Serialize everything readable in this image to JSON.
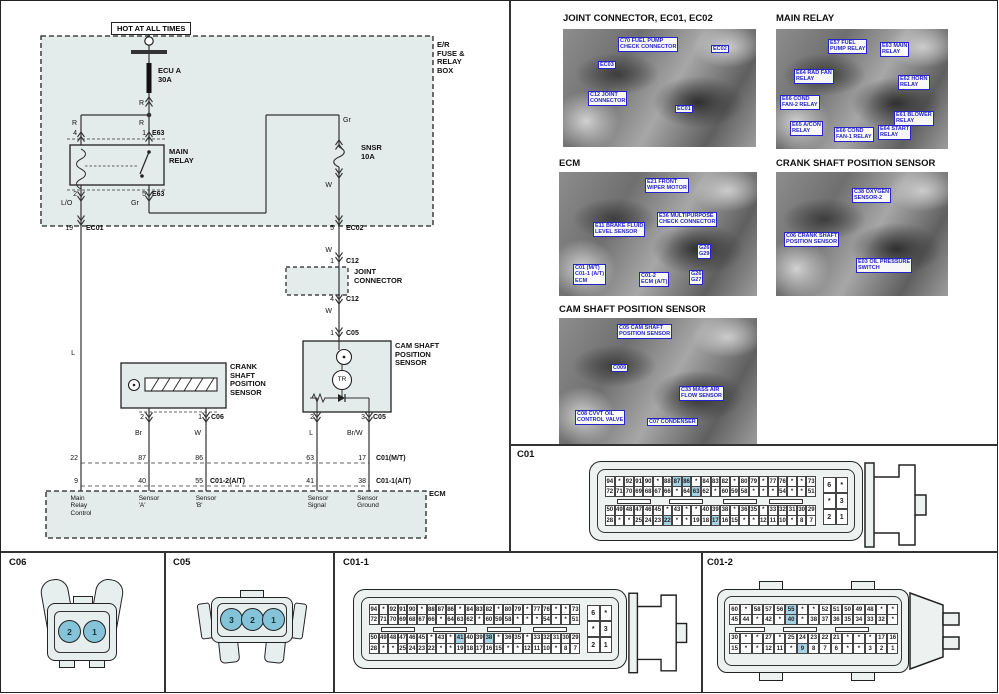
{
  "page": {
    "accent_blue": "#2424c8",
    "panel_fill": "#e3ecea",
    "highlight": "#a6d2e4"
  },
  "schematic": {
    "power_label": "HOT AT ALL TIMES",
    "annotations": [
      {
        "n": "er-fuse-relay-box",
        "t": "E/R\nFUSE &\nRELAY\nBOX",
        "x": 436,
        "y": 40,
        "b": 1,
        "fs": 7.5
      },
      {
        "n": "fuse-ecu-a",
        "t": "ECU A\n30A",
        "x": 157,
        "y": 66,
        "b": 1,
        "fs": 7.5
      },
      {
        "n": "wire-r-1",
        "t": "R",
        "x": 143,
        "y": 99,
        "al": "r"
      },
      {
        "n": "wire-r-2",
        "t": "R",
        "x": 76,
        "y": 119,
        "al": "r"
      },
      {
        "n": "wire-r-3",
        "t": "R",
        "x": 143,
        "y": 119,
        "al": "r"
      },
      {
        "n": "pin-4",
        "t": "4",
        "x": 76,
        "y": 129,
        "al": "r"
      },
      {
        "n": "pin-1",
        "t": "1",
        "x": 145,
        "y": 129,
        "al": "r"
      },
      {
        "n": "conn-e63-top",
        "t": "E63",
        "x": 151,
        "y": 129,
        "b": 1
      },
      {
        "n": "main-relay",
        "t": "MAIN\nRELAY",
        "x": 168,
        "y": 147,
        "b": 1,
        "fs": 7.5
      },
      {
        "n": "pin-2",
        "t": "2",
        "x": 76,
        "y": 190,
        "al": "r"
      },
      {
        "n": "pin-5",
        "t": "5",
        "x": 145,
        "y": 190,
        "al": "r"
      },
      {
        "n": "conn-e63-bottom",
        "t": "E63",
        "x": 151,
        "y": 190,
        "b": 1
      },
      {
        "n": "wire-lo",
        "t": "L/O",
        "x": 60,
        "y": 199
      },
      {
        "n": "wire-gr-1",
        "t": "Gr",
        "x": 130,
        "y": 199
      },
      {
        "n": "wire-gr-2",
        "t": "Gr",
        "x": 342,
        "y": 116
      },
      {
        "n": "fuse-snsr",
        "t": "SNSR\n10A",
        "x": 360,
        "y": 143,
        "b": 1,
        "fs": 7.5
      },
      {
        "n": "wire-w-1",
        "t": "W",
        "x": 331,
        "y": 181,
        "al": "r"
      },
      {
        "n": "pin-19",
        "t": "19",
        "x": 72,
        "y": 224,
        "al": "r"
      },
      {
        "n": "conn-ec01",
        "t": "EC01",
        "x": 85,
        "y": 224,
        "b": 1
      },
      {
        "n": "pin-5-ec02",
        "t": "5",
        "x": 333,
        "y": 224,
        "al": "r"
      },
      {
        "n": "conn-ec02",
        "t": "EC02",
        "x": 345,
        "y": 224,
        "b": 1
      },
      {
        "n": "wire-w-2",
        "t": "W",
        "x": 331,
        "y": 246,
        "al": "r"
      },
      {
        "n": "pin-1-c12",
        "t": "1",
        "x": 333,
        "y": 257,
        "al": "r"
      },
      {
        "n": "conn-c12-top",
        "t": "C12",
        "x": 345,
        "y": 257,
        "b": 1
      },
      {
        "n": "joint-connector",
        "t": "JOINT\nCONNECTOR",
        "x": 353,
        "y": 267,
        "b": 1,
        "fs": 7.5
      },
      {
        "n": "pin-4-c12",
        "t": "4",
        "x": 333,
        "y": 295,
        "al": "r"
      },
      {
        "n": "conn-c12-bottom",
        "t": "C12",
        "x": 345,
        "y": 295,
        "b": 1
      },
      {
        "n": "wire-w-3",
        "t": "W",
        "x": 331,
        "y": 307,
        "al": "r"
      },
      {
        "n": "pin-1-c05",
        "t": "1",
        "x": 333,
        "y": 329,
        "al": "r"
      },
      {
        "n": "conn-c05-top",
        "t": "C05",
        "x": 345,
        "y": 329,
        "b": 1
      },
      {
        "n": "cam-sensor",
        "t": "CAM SHAFT\nPOSITION\nSENSOR",
        "x": 394,
        "y": 341,
        "b": 1,
        "fs": 7.5
      },
      {
        "n": "tr",
        "t": "TR",
        "x": 341,
        "y": 375,
        "al": "c",
        "fs": 6.5
      },
      {
        "n": "wire-l-1",
        "t": "L",
        "x": 74,
        "y": 349,
        "al": "r"
      },
      {
        "n": "crank-sensor",
        "t": "CRANK\nSHAFT\nPOSITION\nSENSOR",
        "x": 229,
        "y": 362,
        "b": 1,
        "fs": 7.5
      },
      {
        "n": "pin-2-c06",
        "t": "2",
        "x": 143,
        "y": 413,
        "al": "r"
      },
      {
        "n": "pin-1-c06",
        "t": "1",
        "x": 201,
        "y": 413,
        "al": "r"
      },
      {
        "n": "conn-c06",
        "t": "C06",
        "x": 210,
        "y": 413,
        "b": 1
      },
      {
        "n": "pin-2-c05",
        "t": "2",
        "x": 313,
        "y": 413,
        "al": "r"
      },
      {
        "n": "pin-3-c05",
        "t": "3",
        "x": 364,
        "y": 413,
        "al": "r"
      },
      {
        "n": "conn-c05-bottom",
        "t": "C05",
        "x": 372,
        "y": 413,
        "b": 1
      },
      {
        "n": "wire-br",
        "t": "Br",
        "x": 141,
        "y": 429,
        "al": "r"
      },
      {
        "n": "wire-w-4",
        "t": "W",
        "x": 200,
        "y": 429,
        "al": "r"
      },
      {
        "n": "wire-l-2",
        "t": "L",
        "x": 312,
        "y": 429,
        "al": "r"
      },
      {
        "n": "wire-brw",
        "t": "Br/W",
        "x": 346,
        "y": 429
      },
      {
        "n": "ecm-pin-22",
        "t": "22",
        "x": 77,
        "y": 454,
        "al": "r"
      },
      {
        "n": "ecm-pin-87",
        "t": "87",
        "x": 145,
        "y": 454,
        "al": "r"
      },
      {
        "n": "ecm-pin-86",
        "t": "86",
        "x": 202,
        "y": 454,
        "al": "r"
      },
      {
        "n": "ecm-pin-63",
        "t": "63",
        "x": 313,
        "y": 454,
        "al": "r"
      },
      {
        "n": "ecm-pin-17",
        "t": "17",
        "x": 365,
        "y": 454,
        "al": "r"
      },
      {
        "n": "conn-c01-mt",
        "t": "C01(M/T)",
        "x": 375,
        "y": 454,
        "b": 1
      },
      {
        "n": "ecm-pin-9",
        "t": "9",
        "x": 77,
        "y": 477,
        "al": "r"
      },
      {
        "n": "ecm-pin-40",
        "t": "40",
        "x": 145,
        "y": 477,
        "al": "r"
      },
      {
        "n": "ecm-pin-55",
        "t": "55",
        "x": 202,
        "y": 477,
        "al": "r"
      },
      {
        "n": "conn-c01-2-at",
        "t": "C01-2(A/T)",
        "x": 209,
        "y": 477,
        "b": 1
      },
      {
        "n": "ecm-pin-41",
        "t": "41",
        "x": 313,
        "y": 477,
        "al": "r"
      },
      {
        "n": "ecm-pin-38",
        "t": "38",
        "x": 365,
        "y": 477,
        "al": "r"
      },
      {
        "n": "conn-c01-1-at",
        "t": "C01-1(A/T)",
        "x": 375,
        "y": 477,
        "b": 1
      },
      {
        "n": "ecm-fn-main-relay-control",
        "t": "Main\nRelay\nControl",
        "x": 80,
        "y": 494,
        "al": "c",
        "fs": 6.5
      },
      {
        "n": "ecm-fn-sensor-a",
        "t": "Sensor\n'A'",
        "x": 148,
        "y": 494,
        "al": "c",
        "fs": 6.5
      },
      {
        "n": "ecm-fn-sensor-b",
        "t": "Sensor\n'B'",
        "x": 205,
        "y": 494,
        "al": "c",
        "fs": 6.5
      },
      {
        "n": "ecm-fn-sensor-signal",
        "t": "Sensor\nSignal",
        "x": 317,
        "y": 494,
        "al": "c",
        "fs": 6.5
      },
      {
        "n": "ecm-fn-sensor-ground",
        "t": "Sensor\nGround",
        "x": 367,
        "y": 494,
        "al": "c",
        "fs": 6.5
      },
      {
        "n": "ecm",
        "t": "ECM",
        "x": 428,
        "y": 489,
        "b": 1,
        "fs": 7.5
      }
    ]
  },
  "photos": [
    {
      "title": "JOINT CONNECTOR, EC01, EC02",
      "callouts": [
        {
          "text": "C70 FUEL PUMP\nCHECK CONNECTOR",
          "x": 55,
          "y": 8
        },
        {
          "text": "EC02",
          "x": 148,
          "y": 16
        },
        {
          "text": "EC03",
          "x": 35,
          "y": 32
        },
        {
          "text": "C12 JOINT\nCONNECTOR",
          "x": 25,
          "y": 62
        },
        {
          "text": "EC01",
          "x": 112,
          "y": 76
        }
      ]
    },
    {
      "title": "MAIN RELAY",
      "callouts": [
        {
          "text": "E57 FUEL\nPUMP RELAY",
          "x": 52,
          "y": 10
        },
        {
          "text": "E63 MAIN\nRELAY",
          "x": 104,
          "y": 13
        },
        {
          "text": "E64 RAD FAN\nRELAY",
          "x": 18,
          "y": 40
        },
        {
          "text": "E62 HORN\nRELAY",
          "x": 122,
          "y": 46
        },
        {
          "text": "E66 COND\nFAN-2 RELAY",
          "x": 4,
          "y": 66
        },
        {
          "text": "E65 A/CON\nRELAY",
          "x": 14,
          "y": 92
        },
        {
          "text": "E66 COND\nFAN-1 RELAY",
          "x": 58,
          "y": 98
        },
        {
          "text": "E64 START\nRELAY",
          "x": 102,
          "y": 96
        },
        {
          "text": "E61 BLOWER\nRELAY",
          "x": 118,
          "y": 82
        }
      ]
    },
    {
      "title": "ECM",
      "callouts": [
        {
          "text": "E21 FRONT\nWIPER MOTOR",
          "x": 86,
          "y": 6
        },
        {
          "text": "E36 MULTIPURPOSE\nCHECK CONNECTOR",
          "x": 98,
          "y": 40
        },
        {
          "text": "E11 BRAKE FLUID\nLEVEL SENSOR",
          "x": 34,
          "y": 50
        },
        {
          "text": "G26\nG29",
          "x": 138,
          "y": 72
        },
        {
          "text": "C01 (M/T)\nC01-1 (A/T)\nECM",
          "x": 14,
          "y": 92
        },
        {
          "text": "C01-2\nECM (A/T)",
          "x": 80,
          "y": 100
        },
        {
          "text": "G26\nG27",
          "x": 130,
          "y": 98
        }
      ]
    },
    {
      "title": "CRANK SHAFT POSITION SENSOR",
      "callouts": [
        {
          "text": "C38 OXYGEN\nSENSOR-2",
          "x": 76,
          "y": 16
        },
        {
          "text": "C06 CRANK SHAFT\nPOSITION SENSOR",
          "x": 8,
          "y": 60
        },
        {
          "text": "E03 OIL PRESSURE\nSWITCH",
          "x": 80,
          "y": 86
        }
      ]
    },
    {
      "title": "CAM SHAFT POSITION SENSOR",
      "callouts": [
        {
          "text": "C05 CAM SHAFT\nPOSITION SENSOR",
          "x": 58,
          "y": 6
        },
        {
          "text": "C009",
          "x": 52,
          "y": 46
        },
        {
          "text": "C33 MASS AIR\nFLOW SENSOR",
          "x": 120,
          "y": 68
        },
        {
          "text": "C08 CVVT OIL\nCONTROL VALVE",
          "x": 16,
          "y": 92
        },
        {
          "text": "C07 CONDENSER",
          "x": 88,
          "y": 100
        }
      ]
    }
  ],
  "connectors": {
    "c01": {
      "title": "C01",
      "rows": [
        [
          "94",
          "*",
          "92",
          "91",
          "90",
          "*",
          "88",
          "87",
          "86",
          "*",
          "84",
          "83",
          "82",
          "*",
          "80",
          "79",
          "*",
          "77",
          "76",
          "*",
          "*",
          "73"
        ],
        [
          "72",
          "71",
          "70",
          "69",
          "68",
          "67",
          "66",
          "*",
          "64",
          "63",
          "62",
          "*",
          "60",
          "59",
          "58",
          "*",
          "*",
          "*",
          "54",
          "*",
          "*",
          "51"
        ],
        [
          "50",
          "49",
          "48",
          "47",
          "46",
          "45",
          "*",
          "43",
          "*",
          "*",
          "40",
          "39",
          "38",
          "*",
          "36",
          "35",
          "*",
          "33",
          "32",
          "31",
          "30",
          "29"
        ],
        [
          "28",
          "*",
          "*",
          "25",
          "24",
          "23",
          "22",
          "*",
          "*",
          "19",
          "18",
          "17",
          "16",
          "15",
          "*",
          "*",
          "12",
          "11",
          "10",
          "*",
          "8",
          "7"
        ]
      ],
      "highlights": [
        [
          0,
          7
        ],
        [
          0,
          8
        ],
        [
          1,
          9
        ],
        [
          3,
          6
        ],
        [
          3,
          11
        ]
      ],
      "side": [
        [
          "6",
          "*"
        ],
        [
          "*",
          "3"
        ],
        [
          "2",
          "1"
        ]
      ]
    },
    "c01_1": {
      "title": "C01-1",
      "rows": [
        [
          "94",
          "*",
          "92",
          "91",
          "90",
          "*",
          "88",
          "87",
          "86",
          "*",
          "84",
          "83",
          "82",
          "*",
          "80",
          "79",
          "*",
          "77",
          "76",
          "*",
          "*",
          "73"
        ],
        [
          "72",
          "71",
          "70",
          "69",
          "68",
          "67",
          "66",
          "*",
          "64",
          "63",
          "62",
          "*",
          "60",
          "59",
          "58",
          "*",
          "*",
          "*",
          "54",
          "*",
          "*",
          "51"
        ],
        [
          "50",
          "49",
          "48",
          "47",
          "46",
          "45",
          "*",
          "43",
          "*",
          "41",
          "40",
          "39",
          "38",
          "*",
          "36",
          "35",
          "*",
          "33",
          "32",
          "31",
          "30",
          "29"
        ],
        [
          "28",
          "*",
          "*",
          "25",
          "24",
          "23",
          "22",
          "*",
          "*",
          "19",
          "18",
          "17",
          "16",
          "15",
          "*",
          "*",
          "12",
          "11",
          "10",
          "*",
          "8",
          "7"
        ]
      ],
      "highlights": [
        [
          2,
          9
        ],
        [
          2,
          12
        ]
      ],
      "side": [
        [
          "6",
          "*"
        ],
        [
          "*",
          "3"
        ],
        [
          "2",
          "1"
        ]
      ]
    },
    "c01_2": {
      "title": "C01-2",
      "rows": [
        [
          "60",
          "*",
          "58",
          "57",
          "56",
          "55",
          "*",
          "*",
          "52",
          "51",
          "50",
          "49",
          "48",
          "*",
          "*"
        ],
        [
          "45",
          "44",
          "*",
          "42",
          "*",
          "40",
          "*",
          "38",
          "37",
          "36",
          "35",
          "34",
          "33",
          "32",
          "*"
        ],
        [
          "30",
          "*",
          "*",
          "27",
          "*",
          "25",
          "24",
          "23",
          "22",
          "21",
          "*",
          "*",
          "*",
          "17",
          "16"
        ],
        [
          "15",
          "*",
          "*",
          "12",
          "11",
          "*",
          "9",
          "8",
          "7",
          "6",
          "*",
          "*",
          "3",
          "2",
          "1"
        ]
      ],
      "highlights": [
        [
          0,
          5
        ],
        [
          1,
          5
        ],
        [
          3,
          6
        ]
      ]
    },
    "c06": {
      "title": "C06",
      "pins": [
        "2",
        "1"
      ]
    },
    "c05": {
      "title": "C05",
      "pins": [
        "3",
        "2",
        "1"
      ]
    }
  }
}
